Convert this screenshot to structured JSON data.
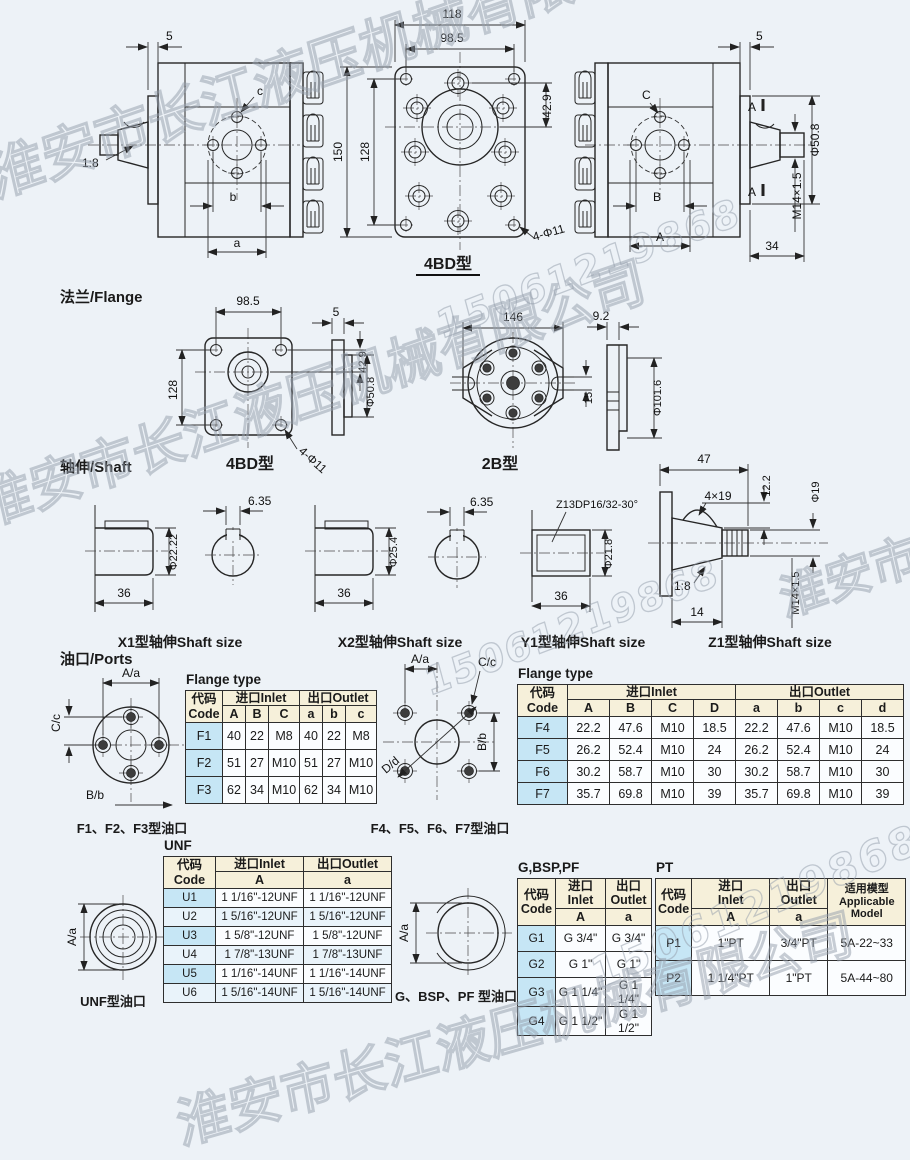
{
  "colors": {
    "background": "#edf2f7",
    "line": "#262626",
    "table_header_bg": "#f6f0da",
    "table_code_bg": "#c6e6f5",
    "table_cell_bg": "#fbfdff",
    "table_alt_bg": "#e9f3fa",
    "watermark": "#96a0ac"
  },
  "watermarks": {
    "company": "淮安市长江液压机械有限公司",
    "phone": "15061219868"
  },
  "headings": {
    "flange": "法兰/Flange",
    "shaft": "轴伸/Shaft",
    "ports": "油口/Ports"
  },
  "top_views": {
    "left": {
      "dim_plate": "5",
      "taper": "1:8",
      "label_a": "a",
      "label_b": "b",
      "label_c": "c"
    },
    "front": {
      "dim_width": "118",
      "dim_bolt_w": "98.5",
      "dim_hole": "42.9",
      "dim_height": "150",
      "dim_bolt_h": "128",
      "note_holes": "4-Φ11",
      "caption": "4BD型"
    },
    "right": {
      "dim_plate": "5",
      "label_c": "C",
      "label_b": "B",
      "label_a": "A",
      "section": "A",
      "dim_dia": "Φ50.8",
      "dim_thread": "M14×1.5",
      "dim_len": "34"
    }
  },
  "flange": {
    "f4bd": {
      "dim_bolt_w": "98.5",
      "dim_bolt_h": "128",
      "dim_hole": "42.9",
      "note_holes": "4-Φ11",
      "caption": "4BD型",
      "plate_t": "5",
      "plate_d": "Φ50.8"
    },
    "f2b": {
      "dim_w": "146",
      "dim_slot": "15",
      "caption": "2B型",
      "plate_t": "9.2",
      "plate_d": "Φ101.6"
    }
  },
  "shafts": {
    "x1": {
      "key": "6.35",
      "dia": "Φ22.22",
      "len": "36",
      "caption": "X1型轴伸Shaft size"
    },
    "x2": {
      "key": "6.35",
      "dia": "Φ25.4",
      "len": "36",
      "caption": "X2型轴伸Shaft size"
    },
    "y1": {
      "spline": "Z13DP16/32-30°",
      "dia": "Φ21.8",
      "len": "36",
      "caption": "Y1型轴伸Shaft size"
    },
    "z1": {
      "len": "47",
      "key": "4×19",
      "key_h": "12.2",
      "dia": "Φ19",
      "taper": "1:8",
      "thread": "M14×1.5",
      "thread_len": "14",
      "caption": "Z1型轴伸Shaft size"
    }
  },
  "ports": {
    "f123": {
      "top": "A/a",
      "left": "C/c",
      "bottom": "B/b",
      "caption": "F1、F2、F3型油口"
    },
    "f4567": {
      "top": "A/a",
      "c": "C/c",
      "d": "D/d",
      "right": "B/b",
      "caption": "F4、F5、F6、F7型油口"
    },
    "unf": {
      "label": "A/a",
      "caption": "UNF型油口"
    },
    "g": {
      "label": "A/a",
      "caption": "G、BSP、PF 型油口"
    }
  },
  "tables": {
    "common": {
      "code_zh": "代码",
      "code_en": "Code",
      "inlet_zh": "进口",
      "inlet_en": "Inlet",
      "outlet_zh": "出口",
      "outlet_en": "Outlet"
    },
    "flange1": {
      "title": "Flange type",
      "subs": [
        "A",
        "B",
        "C",
        "a",
        "b",
        "c"
      ],
      "rows": [
        {
          "code": "F1",
          "cells": [
            "40",
            "22",
            "M8",
            "40",
            "22",
            "M8"
          ]
        },
        {
          "code": "F2",
          "cells": [
            "51",
            "27",
            "M10",
            "51",
            "27",
            "M10"
          ]
        },
        {
          "code": "F3",
          "cells": [
            "62",
            "34",
            "M10",
            "62",
            "34",
            "M10"
          ]
        }
      ]
    },
    "flange2": {
      "title": "Flange type",
      "subs": [
        "A",
        "B",
        "C",
        "D",
        "a",
        "b",
        "c",
        "d"
      ],
      "rows": [
        {
          "code": "F4",
          "cells": [
            "22.2",
            "47.6",
            "M10",
            "18.5",
            "22.2",
            "47.6",
            "M10",
            "18.5"
          ]
        },
        {
          "code": "F5",
          "cells": [
            "26.2",
            "52.4",
            "M10",
            "24",
            "26.2",
            "52.4",
            "M10",
            "24"
          ]
        },
        {
          "code": "F6",
          "cells": [
            "30.2",
            "58.7",
            "M10",
            "30",
            "30.2",
            "58.7",
            "M10",
            "30"
          ]
        },
        {
          "code": "F7",
          "cells": [
            "35.7",
            "69.8",
            "M10",
            "39",
            "35.7",
            "69.8",
            "M10",
            "39"
          ]
        }
      ]
    },
    "unf": {
      "title": "UNF",
      "sub_in": "A",
      "sub_out": "a",
      "rows": [
        {
          "code": "U1",
          "inlet": "1 1/16\"-12UNF",
          "outlet": "1 1/16\"-12UNF"
        },
        {
          "code": "U2",
          "inlet": "1 5/16\"-12UNF",
          "outlet": "1 5/16\"-12UNF"
        },
        {
          "code": "U3",
          "inlet": "1 5/8\"-12UNF",
          "outlet": "1 5/8\"-12UNF"
        },
        {
          "code": "U4",
          "inlet": "1 7/8\"-13UNF",
          "outlet": "1 7/8\"-13UNF"
        },
        {
          "code": "U5",
          "inlet": "1 1/16\"-14UNF",
          "outlet": "1 1/16\"-14UNF"
        },
        {
          "code": "U6",
          "inlet": "1 5/16\"-14UNF",
          "outlet": "1 5/16\"-14UNF"
        }
      ]
    },
    "g": {
      "title": "G,BSP,PF",
      "sub_in": "A",
      "sub_out": "a",
      "rows": [
        {
          "code": "G1",
          "inlet": "G 3/4\"",
          "outlet": "G 3/4\""
        },
        {
          "code": "G2",
          "inlet": "G 1\"",
          "outlet": "G 1\""
        },
        {
          "code": "G3",
          "inlet": "G 1 1/4\"",
          "outlet": "G 1 1/4\""
        },
        {
          "code": "G4",
          "inlet": "G 1 1/2\"",
          "outlet": "G 1 1/2\""
        }
      ]
    },
    "pt": {
      "title": "PT",
      "sub_in": "A",
      "sub_out": "a",
      "model_zh": "适用模型",
      "model_en1": "Applicable",
      "model_en2": "Model",
      "rows": [
        {
          "code": "P1",
          "inlet": "1\"PT",
          "outlet": "3/4\"PT",
          "model": "5A-22~33"
        },
        {
          "code": "P2",
          "inlet": "1 1/4\"PT",
          "outlet": "1\"PT",
          "model": "5A-44~80"
        }
      ]
    }
  }
}
